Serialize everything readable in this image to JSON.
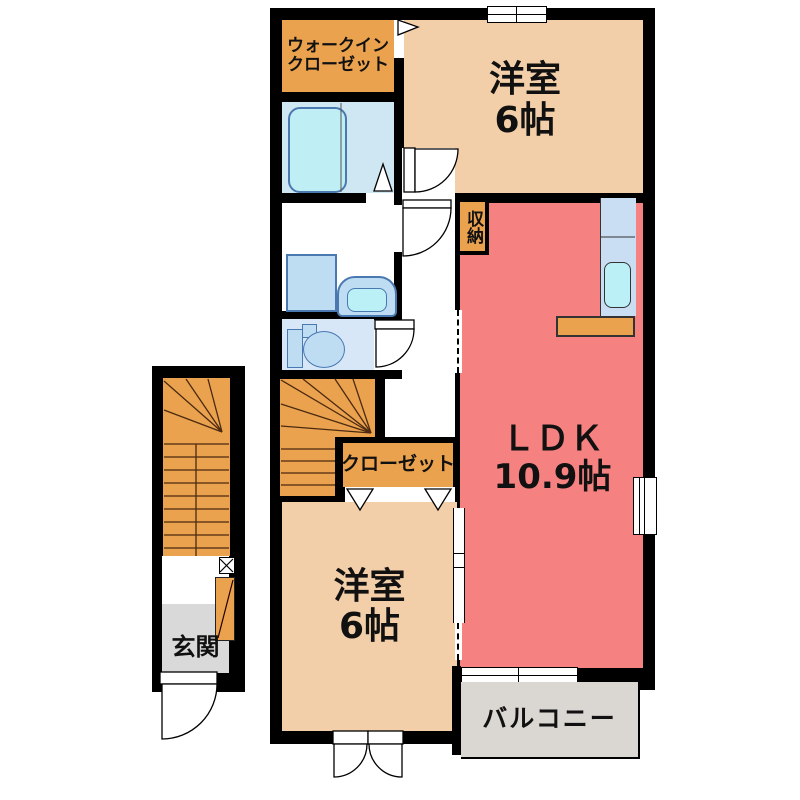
{
  "plan_title": "2F apartment floor plan",
  "colors": {
    "wall": "#000000",
    "bedroom": "#f3cfa9",
    "ldk": "#f58280",
    "accent": "#eba24e",
    "bathroom": "#cfe7f3",
    "bathtub": "#bfeef4",
    "fixtureFill": "#bedcf2",
    "fixtureBorder": "#4a78b0",
    "kitchen": "#c9ddf3",
    "sink": "#baf0f6",
    "toiletRoom": "#d7e7f7",
    "genkan": "#d9d9d9",
    "balcony": "#dad6d2",
    "stairLine": "#4a2a10"
  },
  "rooms": {
    "walk_in_closet": {
      "label": "ウォークイン\nクローゼット"
    },
    "bedroom_top": {
      "name": "洋室",
      "size": "6帖"
    },
    "storage": {
      "label": "収納"
    },
    "ldk": {
      "name": "ＬＤＫ",
      "size": "10.9帖"
    },
    "closet": {
      "label": "クローゼット"
    },
    "bedroom_bottom": {
      "name": "洋室",
      "size": "6帖"
    },
    "entrance": {
      "label": "玄関"
    },
    "balcony": {
      "label": "バルコニー"
    }
  }
}
